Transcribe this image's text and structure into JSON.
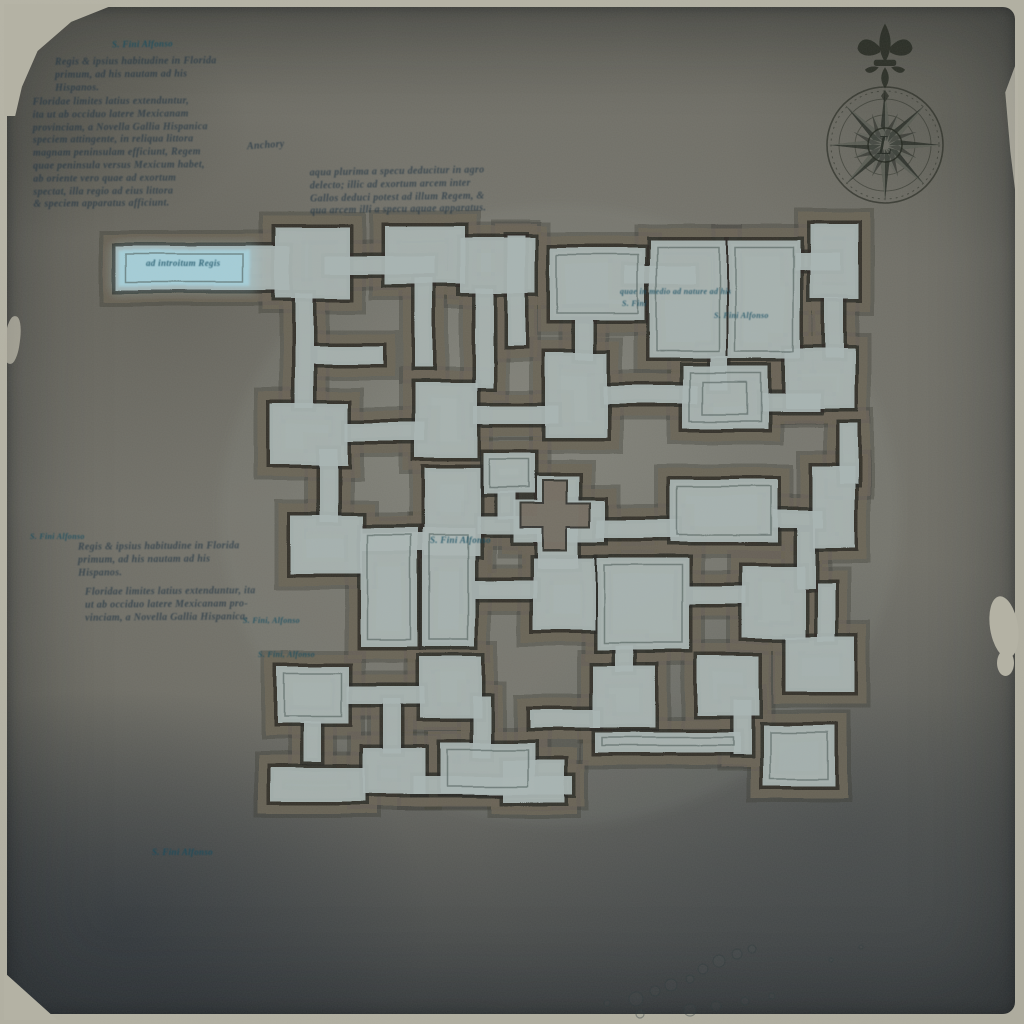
{
  "palette": {
    "frame": "#b2b0a2",
    "parchment": "#6f6e66",
    "floor": "#a9b5b2",
    "wall_band": "#6b6458",
    "outline": "#2c2c26",
    "highlight_room": "#a5d2de",
    "ink": "#22384a",
    "teal_ink": "#174c5f",
    "compass": "#23271f"
  },
  "compass": {
    "center_letter": "L"
  },
  "map": {
    "origin": {
      "x": 265,
      "y": 228
    },
    "rooms": [
      [
        -150,
        18,
        175,
        44
      ],
      [
        10,
        0,
        75,
        70
      ],
      [
        60,
        28,
        110,
        18
      ],
      [
        120,
        -2,
        80,
        58
      ],
      [
        150,
        50,
        18,
        90
      ],
      [
        195,
        10,
        75,
        55
      ],
      [
        242,
        8,
        18,
        110
      ],
      [
        285,
        20,
        95,
        72
      ],
      [
        360,
        38,
        70,
        18
      ],
      [
        385,
        12,
        76,
        118
      ],
      [
        463,
        12,
        72,
        118
      ],
      [
        530,
        25,
        45,
        18
      ],
      [
        545,
        -4,
        48,
        75
      ],
      [
        560,
        70,
        18,
        60
      ],
      [
        520,
        120,
        70,
        60
      ],
      [
        30,
        65,
        18,
        115
      ],
      [
        5,
        175,
        78,
        62
      ],
      [
        80,
        195,
        80,
        18
      ],
      [
        150,
        155,
        62,
        75
      ],
      [
        208,
        178,
        85,
        18
      ],
      [
        280,
        125,
        62,
        85
      ],
      [
        338,
        158,
        95,
        18
      ],
      [
        418,
        138,
        85,
        62
      ],
      [
        495,
        165,
        60,
        18
      ],
      [
        48,
        118,
        70,
        18
      ],
      [
        210,
        60,
        18,
        100
      ],
      [
        310,
        92,
        18,
        40
      ],
      [
        445,
        128,
        18,
        34
      ],
      [
        575,
        195,
        18,
        60
      ],
      [
        55,
        220,
        18,
        75
      ],
      [
        25,
        288,
        72,
        58
      ],
      [
        95,
        305,
        68,
        18
      ],
      [
        160,
        240,
        55,
        88
      ],
      [
        212,
        288,
        68,
        18
      ],
      [
        272,
        248,
        42,
        92
      ],
      [
        248,
        272,
        92,
        42
      ],
      [
        332,
        292,
        82,
        18
      ],
      [
        405,
        252,
        108,
        62
      ],
      [
        508,
        282,
        50,
        18
      ],
      [
        548,
        238,
        42,
        82
      ],
      [
        218,
        225,
        52,
        40
      ],
      [
        232,
        263,
        18,
        28
      ],
      [
        95,
        300,
        58,
        118
      ],
      [
        158,
        300,
        52,
        118
      ],
      [
        210,
        352,
        62,
        18
      ],
      [
        268,
        330,
        62,
        72
      ],
      [
        332,
        330,
        92,
        92
      ],
      [
        424,
        358,
        58,
        18
      ],
      [
        478,
        338,
        62,
        72
      ],
      [
        532,
        300,
        18,
        60
      ],
      [
        552,
        355,
        18,
        58
      ],
      [
        520,
        408,
        70,
        56
      ],
      [
        12,
        438,
        72,
        58
      ],
      [
        82,
        458,
        78,
        18
      ],
      [
        155,
        428,
        62,
        62
      ],
      [
        208,
        468,
        18,
        62
      ],
      [
        175,
        515,
        95,
        50
      ],
      [
        265,
        482,
        70,
        18
      ],
      [
        328,
        438,
        62,
        62
      ],
      [
        330,
        505,
        145,
        20
      ],
      [
        432,
        428,
        62,
        60
      ],
      [
        468,
        472,
        18,
        55
      ],
      [
        498,
        498,
        72,
        60
      ],
      [
        238,
        532,
        62,
        42
      ],
      [
        98,
        520,
        62,
        46
      ],
      [
        38,
        494,
        18,
        40
      ],
      [
        5,
        540,
        95,
        34
      ],
      [
        148,
        548,
        160,
        18
      ],
      [
        350,
        418,
        18,
        26
      ],
      [
        118,
        470,
        18,
        55
      ]
    ],
    "inner_sketch": [
      [
        -140,
        26,
        118,
        28
      ],
      [
        292,
        27,
        81,
        58
      ],
      [
        392,
        19,
        62,
        104
      ],
      [
        470,
        19,
        58,
        104
      ],
      [
        412,
        259,
        94,
        48
      ],
      [
        102,
        307,
        44,
        104
      ],
      [
        165,
        307,
        38,
        104
      ],
      [
        339,
        337,
        78,
        78
      ],
      [
        19,
        445,
        58,
        44
      ],
      [
        505,
        505,
        58,
        46
      ],
      [
        425,
        145,
        71,
        48
      ],
      [
        438,
        154,
        44,
        32
      ],
      [
        337,
        510,
        131,
        8
      ],
      [
        182,
        522,
        81,
        36
      ],
      [
        224,
        231,
        40,
        28
      ]
    ],
    "highlight_room": [
      -147,
      22,
      132,
      36
    ],
    "wall_cross": {
      "cx": 290,
      "cy": 287,
      "arm": 35,
      "t": 24
    }
  },
  "decor": {
    "pebbles": [
      [
        636,
        999,
        7
      ],
      [
        655,
        991,
        5
      ],
      [
        671,
        985,
        6
      ],
      [
        690,
        979,
        4
      ],
      [
        703,
        969,
        5
      ],
      [
        719,
        961,
        6
      ],
      [
        737,
        954,
        5
      ],
      [
        752,
        949,
        4
      ],
      [
        690,
        1010,
        6
      ],
      [
        716,
        1006,
        5
      ],
      [
        745,
        1001,
        4
      ],
      [
        772,
        996,
        3
      ],
      [
        640,
        1014,
        4
      ],
      [
        607,
        1003,
        3
      ],
      [
        831,
        960,
        2
      ],
      [
        861,
        947,
        2
      ]
    ]
  },
  "annotations": [
    {
      "name": "tag-top",
      "x": 112,
      "y": 39,
      "size": 9,
      "color": "teal",
      "rot": -1,
      "lines": [
        "S. Fini Alfonso"
      ]
    },
    {
      "name": "paragraph-1",
      "x": 55,
      "y": 56,
      "size": 10,
      "color": "ink",
      "rot": -0.5,
      "lines": [
        "Regis & ipsius habitudine in Florida",
        "primum, ad his nautam ad his",
        "Hispanos."
      ]
    },
    {
      "name": "paragraph-2",
      "x": 33,
      "y": 96,
      "size": 10,
      "color": "ink",
      "rot": -0.5,
      "lines": [
        "Floridae limites latius extenduntur,",
        "ita ut ab occiduo latere Mexicanam",
        "provinciam, a Novella Gallia Hispanica",
        "speciem attingente, in reliqua littora",
        "magnam peninsulam efficiunt, Regem",
        "quae peninsula versus Mexicum habet,",
        "ab oriente vero quae ad exortum",
        "spectat, illa regio ad eius littora",
        "& speciem apparatus afficiunt."
      ]
    },
    {
      "name": "word-anchory",
      "x": 247,
      "y": 140,
      "size": 10,
      "color": "ink",
      "rot": -4,
      "lines": [
        "Anchory"
      ]
    },
    {
      "name": "paragraph-3",
      "x": 310,
      "y": 166,
      "size": 10,
      "color": "ink",
      "rot": -1,
      "lines": [
        "aqua plurima a specu deducitur in agro",
        "delecto; illic ad exortum arcem inter",
        "Gallos deduci potest ad illum Regem, &",
        "qua arcem illi a specu aquae apparatus."
      ]
    },
    {
      "name": "paragraph-4",
      "x": 78,
      "y": 541,
      "size": 10,
      "color": "ink",
      "rot": -0.5,
      "lines": [
        "Regis & ipsius habitudine in Florida",
        "primum, ad his nautam ad his",
        "Hispanos."
      ]
    },
    {
      "name": "paragraph-5",
      "x": 85,
      "y": 586,
      "size": 10,
      "color": "ink",
      "rot": -0.5,
      "lines": [
        "Floridae limites latius extenduntur, ita",
        "ut ab occiduo latere Mexicanam pro-",
        "vinciam, a Novella Gallia Hispanica."
      ]
    },
    {
      "name": "tag-left-1",
      "x": 30,
      "y": 532,
      "size": 8,
      "color": "teal",
      "rot": 0,
      "lines": [
        "S. Fini Alfonso"
      ]
    },
    {
      "name": "tag-left-2",
      "x": 243,
      "y": 616,
      "size": 8,
      "color": "teal",
      "rot": 0,
      "lines": [
        "S. Fini, Alfonso"
      ]
    },
    {
      "name": "tag-left-3",
      "x": 258,
      "y": 650,
      "size": 8,
      "color": "teal",
      "rot": 0,
      "lines": [
        "S. Fini, Alfonso"
      ]
    },
    {
      "name": "tag-bottom",
      "x": 152,
      "y": 847,
      "size": 9,
      "color": "teal",
      "rot": 0,
      "lines": [
        "S. Fini Alfonso"
      ]
    },
    {
      "name": "tag-map-center",
      "x": 430,
      "y": 535,
      "size": 9,
      "color": "teal",
      "rot": 0,
      "lines": [
        "S. Fini Alfonso"
      ]
    },
    {
      "name": "note-ne-room",
      "x": 620,
      "y": 287,
      "size": 8,
      "color": "teal",
      "rot": 0,
      "lines": [
        "quae in medio ad nature ad his"
      ]
    },
    {
      "name": "note-ne-room-2",
      "x": 622,
      "y": 299,
      "size": 8,
      "color": "teal",
      "rot": 0,
      "lines": [
        "S. Fini"
      ]
    },
    {
      "name": "tag-ne",
      "x": 714,
      "y": 311,
      "size": 8,
      "color": "teal",
      "rot": 0,
      "lines": [
        "S. Fini Alfonso"
      ]
    },
    {
      "name": "entrance-label",
      "x": 146,
      "y": 258,
      "size": 9,
      "color": "teal",
      "rot": 0,
      "lines": [
        "ad introitum Regis"
      ]
    }
  ]
}
